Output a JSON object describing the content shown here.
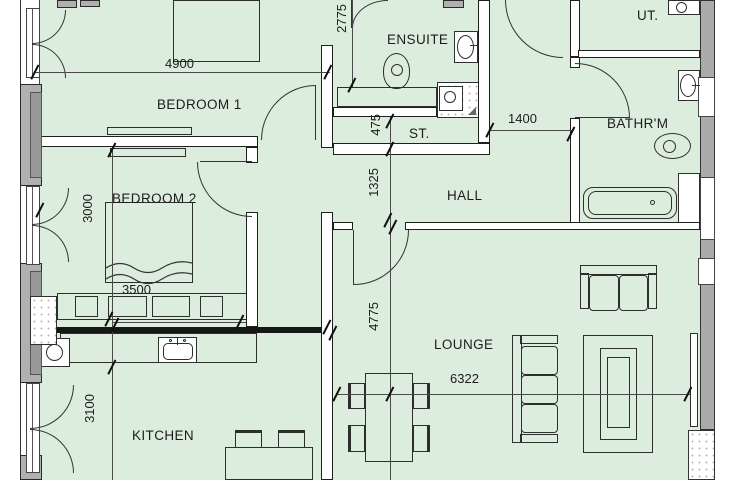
{
  "title": "apartment-floor-plan",
  "rooms": [
    {
      "id": "bedroom-1",
      "label": "BEDROOM 1"
    },
    {
      "id": "bedroom-2",
      "label": "BEDROOM 2"
    },
    {
      "id": "ensuite",
      "label": "ENSUITE"
    },
    {
      "id": "store",
      "label": "ST."
    },
    {
      "id": "hall",
      "label": "HALL"
    },
    {
      "id": "bathroom",
      "label": "BATHR'M"
    },
    {
      "id": "utility",
      "label": "UT."
    },
    {
      "id": "lounge",
      "label": "LOUNGE"
    },
    {
      "id": "kitchen",
      "label": "KITCHEN"
    }
  ],
  "dimensions": [
    {
      "id": "bedroom1-width",
      "value": "4900"
    },
    {
      "id": "ensuite-length",
      "value": "2775"
    },
    {
      "id": "store-depth",
      "value": "475"
    },
    {
      "id": "hall-width",
      "value": "1325"
    },
    {
      "id": "corridor-width",
      "value": "1400"
    },
    {
      "id": "bedroom2-depth",
      "value": "3000"
    },
    {
      "id": "bedroom2-width",
      "value": "3500"
    },
    {
      "id": "lounge-depth",
      "value": "4775"
    },
    {
      "id": "lounge-width",
      "value": "6322"
    },
    {
      "id": "kitchen-depth",
      "value": "3100"
    }
  ],
  "colors": {
    "room_fill": "#ddeddd",
    "wall_fill": "#ffffff",
    "wall_line": "#1f1f1f",
    "masonry_gray": "#b0b0b0",
    "right_wall_gray": "#ababab"
  }
}
